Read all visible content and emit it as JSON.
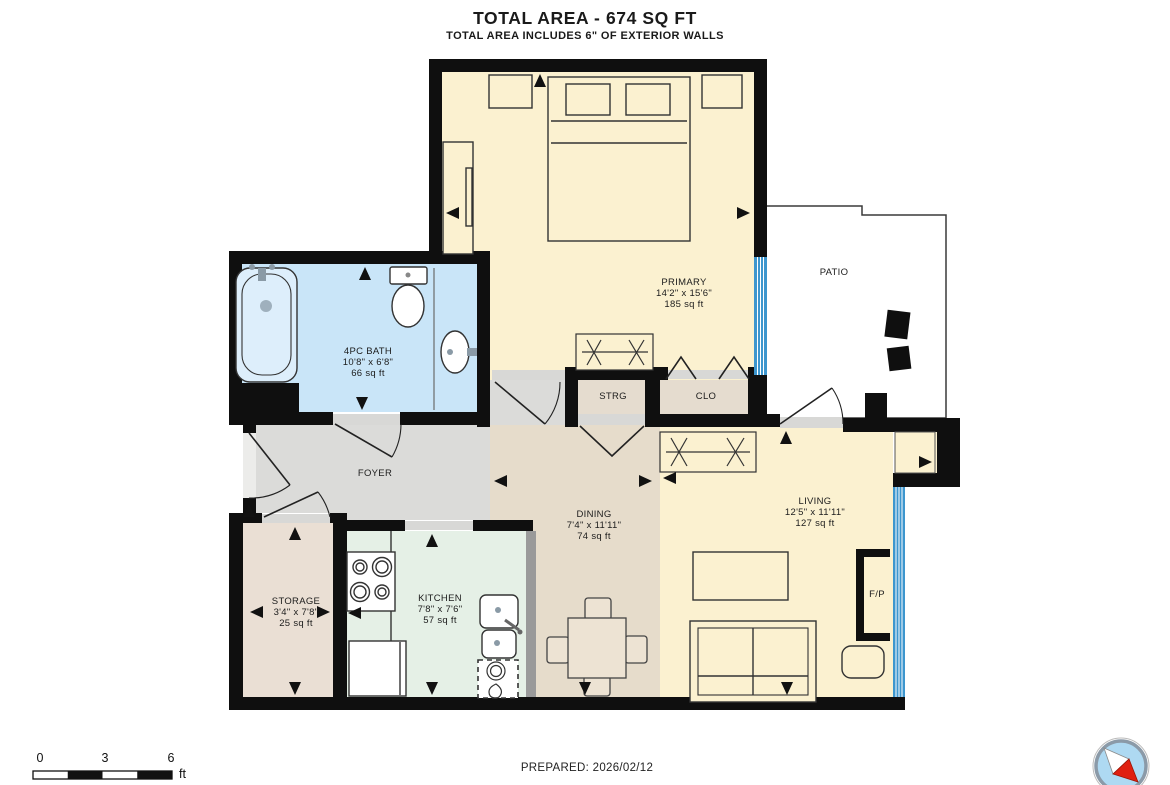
{
  "header": {
    "title": "TOTAL AREA - 674 SQ FT",
    "subtitle": "TOTAL AREA INCLUDES 6\" OF EXTERIOR WALLS"
  },
  "rooms": {
    "primary": {
      "name": "PRIMARY",
      "dims": "14'2\" x 15'6\"",
      "area": "185 sq ft"
    },
    "patio": {
      "name": "PATIO"
    },
    "bath": {
      "name": "4PC BATH",
      "dims": "10'8\" x 6'8\"",
      "area": "66 sq ft"
    },
    "strg": {
      "name": "STRG"
    },
    "clo": {
      "name": "CLO"
    },
    "foyer": {
      "name": "FOYER"
    },
    "dining": {
      "name": "DINING",
      "dims": "7'4\" x 11'11\"",
      "area": "74 sq ft"
    },
    "living": {
      "name": "LIVING",
      "dims": "12'5\" x 11'11\"",
      "area": "127 sq ft"
    },
    "storage": {
      "name": "STORAGE",
      "dims": "3'4\" x 7'8\"",
      "area": "25 sq ft"
    },
    "kitchen": {
      "name": "KITCHEN",
      "dims": "7'8\" x 7'6\"",
      "area": "57 sq ft"
    },
    "fireplace": {
      "name": "F/P"
    }
  },
  "scale_bar": {
    "ticks": [
      "0",
      "3",
      "6"
    ],
    "unit": "ft"
  },
  "footer": {
    "prepared": "PREPARED: 2026/02/12"
  },
  "colors": {
    "wall": "#0f0f0f",
    "window_blue": "#3d96ce",
    "room_cream": "#fbf1d0",
    "bath_blue": "#c9e5f8",
    "foyer_gray": "#dbdbd9",
    "dining_tan": "#e6dccb",
    "storage_tan": "#eadfd4",
    "closet_tan": "#e5dccf",
    "kitchen_green": "#e5f0e6",
    "compass_needle_red": "#e02010"
  }
}
